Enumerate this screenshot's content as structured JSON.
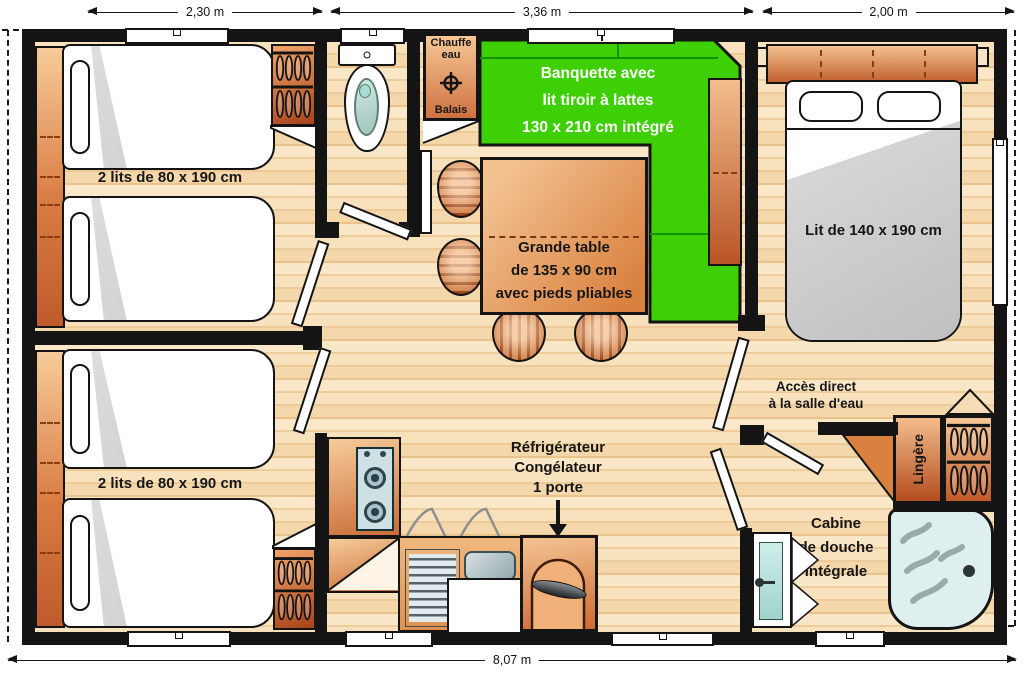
{
  "plan": {
    "dimensions": {
      "top": [
        "2,30 m",
        "3,36 m",
        "2,00 m"
      ],
      "overall_width": "8,07 m"
    },
    "rooms": {
      "bedroom_left_top": {
        "beds_label": "2 lits de 80 x 190 cm"
      },
      "bedroom_left_bottom": {
        "beds_label": "2 lits de 80 x 190 cm"
      },
      "utility": {
        "water_heater_label": "Chauffe\neau",
        "broom_label": "Balais"
      },
      "living": {
        "banquette_label": "Banquette avec\nlit tiroir à lattes\n130 x 210 cm intégré",
        "table_label": "Grande table\nde 135 x 90 cm\navec pieds pliables"
      },
      "kitchen": {
        "fridge_label": "Réfrigérateur\nCongélateur\n1 porte"
      },
      "master_bedroom": {
        "bed_label": "Lit de 140 x 190 cm",
        "access_label": "Accès direct\nà la salle d'eau"
      },
      "bathroom": {
        "linen_label": "Lingère",
        "shower_label": "Cabine\nde douche\nintégrale"
      }
    },
    "colors": {
      "banquette_green": "#3ed004",
      "floor_wood_light": "#f6dcb4",
      "furniture_orange": "#e08a4e",
      "wall_black": "#141414",
      "shower_blue": "#ddf0ef"
    }
  }
}
